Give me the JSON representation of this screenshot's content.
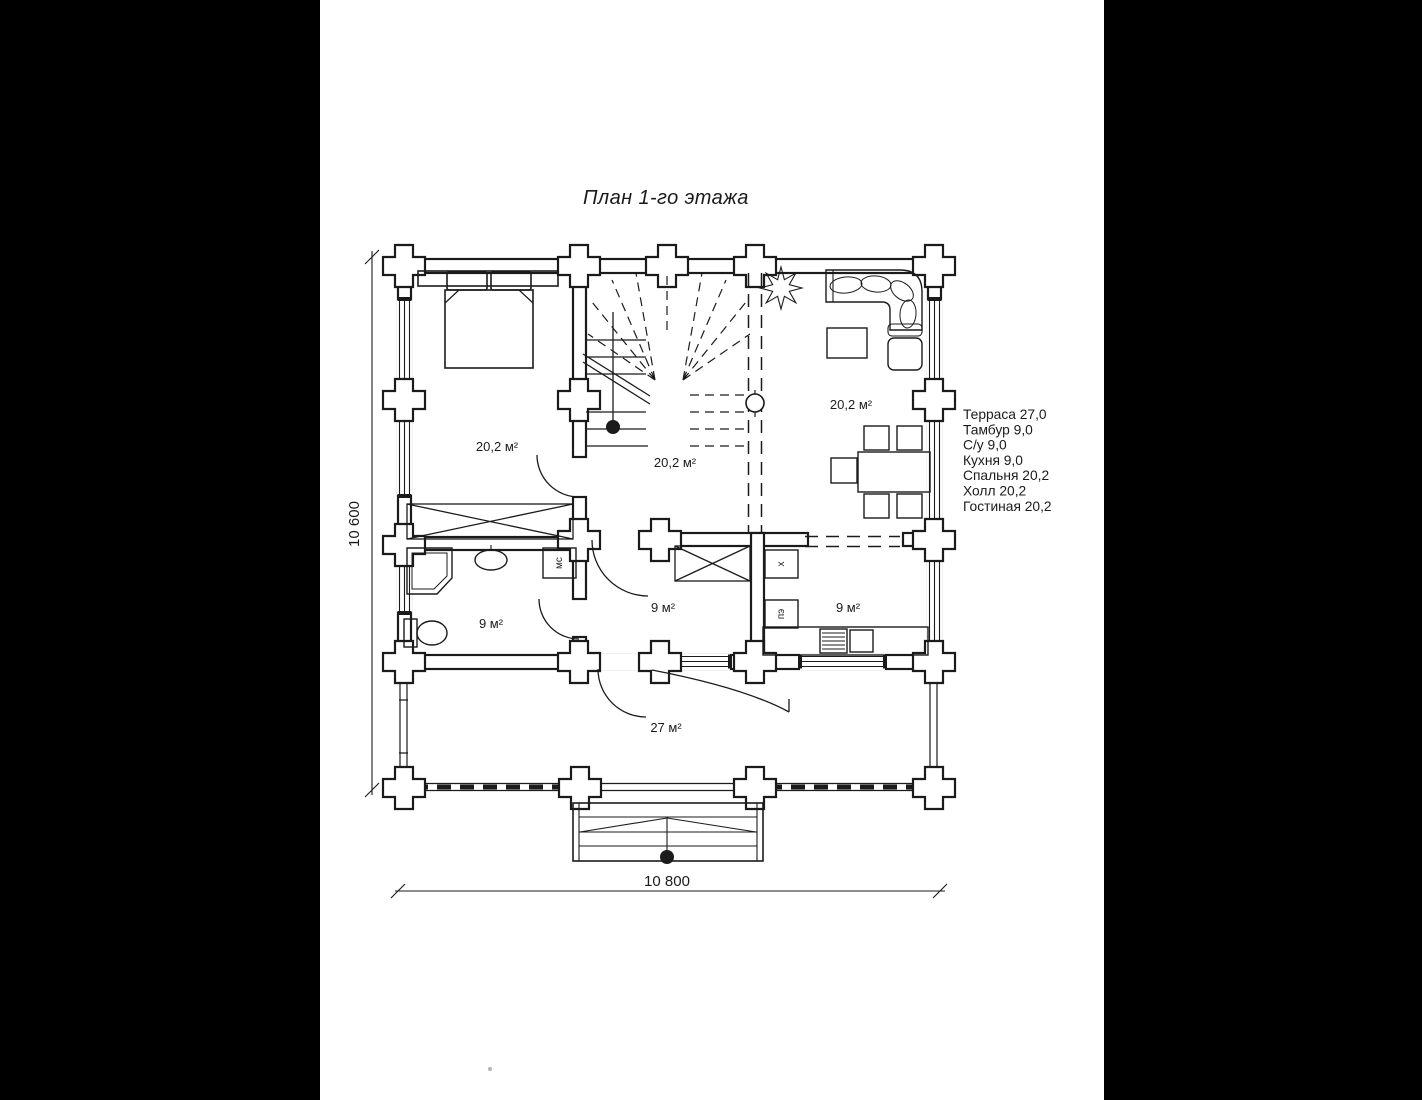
{
  "title": "План 1-го этажа",
  "legend": {
    "items": [
      "Терраса 27,0",
      "Тамбур 9,0",
      "С/у 9,0",
      "Кухня 9,0",
      "Спальня 20,2",
      "Холл 20,2",
      "Гостиная 20,2"
    ]
  },
  "dimensions": {
    "width": "10 800",
    "height": "10 600"
  },
  "rooms": [
    {
      "name": "Спальня",
      "area_label": "20,2 м²"
    },
    {
      "name": "Холл",
      "area_label": "20,2 м²"
    },
    {
      "name": "Гостиная",
      "area_label": "20,2 м²"
    },
    {
      "name": "С/у",
      "area_label": "9 м²"
    },
    {
      "name": "Тамбур",
      "area_label": "9 м²"
    },
    {
      "name": "Кухня",
      "area_label": "9 м²"
    },
    {
      "name": "Терраса",
      "area_label": "27 м²"
    }
  ],
  "appliances": [
    {
      "label": "мс"
    },
    {
      "label": "х"
    },
    {
      "label": "пэ"
    }
  ],
  "colors": {
    "background": "#ffffff",
    "letterbox": "#000000",
    "ink": "#1b1b1b"
  }
}
